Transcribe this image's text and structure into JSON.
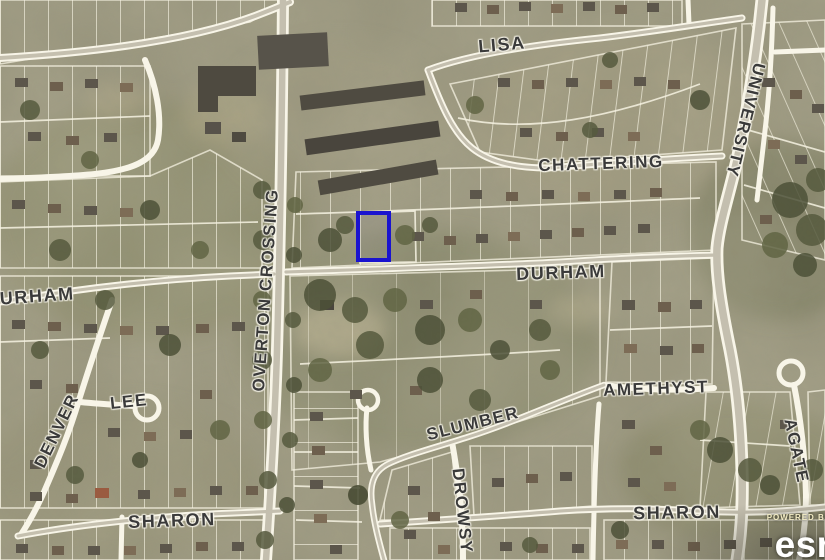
{
  "map": {
    "labels": [
      {
        "name": "lisa",
        "text": "LISA"
      },
      {
        "name": "chattering",
        "text": "CHATTERING"
      },
      {
        "name": "university",
        "text": "UNIVERSITY"
      },
      {
        "name": "overton-crossing",
        "text": "OVERTON CROSSING"
      },
      {
        "name": "durham-west",
        "text": "DURHAM"
      },
      {
        "name": "durham",
        "text": "DURHAM"
      },
      {
        "name": "lee",
        "text": "LEE"
      },
      {
        "name": "denver",
        "text": "DENVER"
      },
      {
        "name": "amethyst",
        "text": "AMETHYST"
      },
      {
        "name": "agate",
        "text": "AGATE"
      },
      {
        "name": "slumber",
        "text": "SLUMBER"
      },
      {
        "name": "drowsy",
        "text": "DROWSY"
      },
      {
        "name": "sharon-west",
        "text": "SHARON"
      },
      {
        "name": "sharon-east",
        "text": "SHARON"
      }
    ],
    "highlight": {
      "color": "#1a13cf"
    },
    "attribution": {
      "powered_by": "POWERED BY",
      "brand": "esri"
    }
  }
}
